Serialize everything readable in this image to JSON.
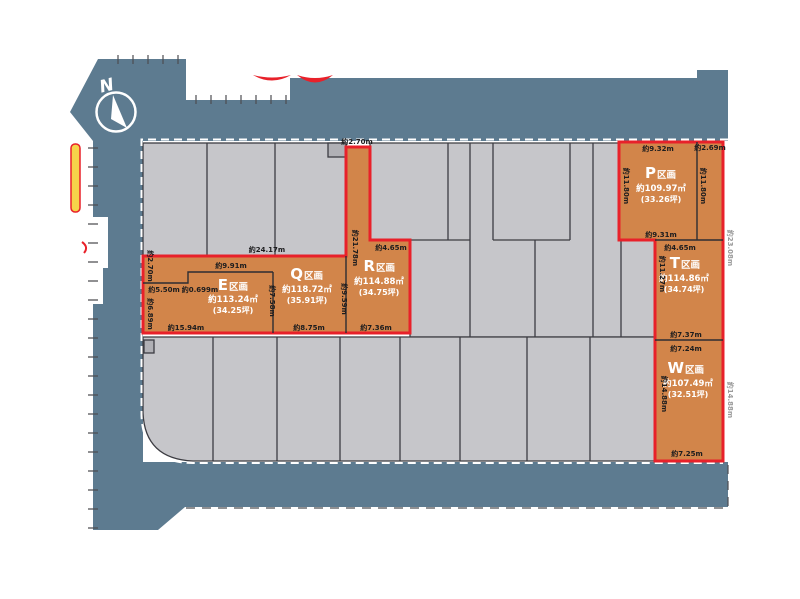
{
  "map": {
    "north_label": "N",
    "colors": {
      "road": "#5d7b90",
      "lot_gray": "#c6c6ca",
      "highlight_orange": "#d2854a",
      "border_red": "#e8212a"
    },
    "lots": {
      "E": {
        "letter": "E",
        "suffix": "区画",
        "area": "約113.24㎡",
        "tsubo": "(34.25坪)",
        "dims": {
          "top": "約9.91m",
          "top_left": "約5.50m",
          "step": "約0.699m",
          "left_upper": "約2.70m",
          "left": "約6.89m",
          "right": "約7.58m",
          "bottom": "約15.94m"
        }
      },
      "Q": {
        "letter": "Q",
        "suffix": "区画",
        "area": "約118.72㎡",
        "tsubo": "(35.91坪)",
        "dims": {
          "top": "約24.17m",
          "right": "約9.59m",
          "bottom": "約8.75m"
        }
      },
      "R": {
        "letter": "R",
        "suffix": "区画",
        "area": "約114.88㎡",
        "tsubo": "(34.75坪)",
        "dims": {
          "top": "約2.70m",
          "pole_left": "約21.78m",
          "step": "約4.65m",
          "bottom": "約7.36m"
        }
      },
      "P": {
        "letter": "P",
        "suffix": "区画",
        "area": "約109.97㎡",
        "tsubo": "(33.26坪)",
        "dims": {
          "top": "約9.32m",
          "top_right": "約2.69m",
          "left": "約11.80m",
          "right": "約11.80m",
          "bottom": "約9.31m"
        }
      },
      "T": {
        "letter": "T",
        "suffix": "区画",
        "area": "約114.86㎡",
        "tsubo": "(34.74坪)",
        "dims": {
          "top": "約4.65m",
          "left": "約11.27m",
          "bottom": "約7.37m",
          "right_outside": "約23.08m"
        }
      },
      "W": {
        "letter": "W",
        "suffix": "区画",
        "area": "約107.49㎡",
        "tsubo": "(32.51坪)",
        "dims": {
          "top": "約7.24m",
          "left": "約14.88m",
          "bottom": "約7.25m",
          "right_outside": "約14.88m"
        }
      }
    }
  }
}
